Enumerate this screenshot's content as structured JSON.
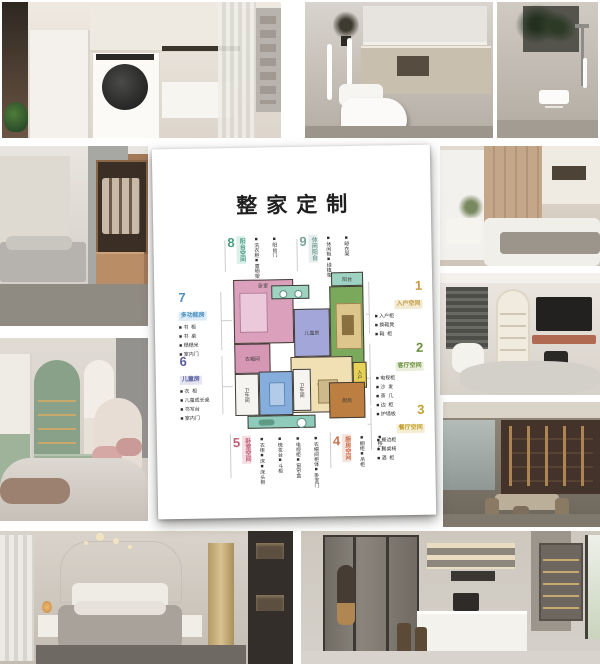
{
  "poster": {
    "title": "整家定制",
    "zones": {
      "z1": {
        "num": "1",
        "name": "入户空间",
        "color": "#c49a3f",
        "tint": "#f3ead3",
        "items": [
          "入户柜",
          "换鞋凳",
          "鞋  柜"
        ]
      },
      "z2": {
        "num": "2",
        "name": "客厅空间",
        "color": "#6b8f3f",
        "tint": "#e9efdb",
        "items": [
          "电视柜",
          "沙  发",
          "茶  几",
          "边  柜",
          "护墙板"
        ]
      },
      "z3": {
        "num": "3",
        "name": "餐厅空间",
        "color": "#c2a02e",
        "tint": "#f4edd2",
        "items": [
          "餐边柜",
          "餐桌椅",
          "酒  柜"
        ]
      },
      "z4": {
        "num": "4",
        "name": "厨房空间",
        "color": "#cd6f4e",
        "tint": "#f6e4dc",
        "items": [
          "橱柜",
          "吊柜",
          "移门"
        ]
      },
      "z5": {
        "num": "5",
        "name": "卧室空间",
        "color": "#c05c74",
        "tint": "#f5dee4",
        "items": [
          "衣柜",
          "床",
          "床头柜",
          "梳妆台",
          "斗柜",
          "电视柜",
          "窗帘盒",
          "衣帽间柜体",
          "卧室门"
        ]
      },
      "z6": {
        "num": "6",
        "name": "儿童房",
        "color": "#5c5fa0",
        "tint": "#e3e4f0",
        "items": [
          "衣  柜",
          "儿童成长桌",
          "书写台",
          "室内门"
        ]
      },
      "z7": {
        "num": "7",
        "name": "多功能房",
        "color": "#4a8fc2",
        "tint": "#dcebf5",
        "items": [
          "书  柜",
          "书  桌",
          "榻榻米",
          "室内门"
        ]
      },
      "z8": {
        "num": "8",
        "name": "阳台空间",
        "color": "#4d9e86",
        "tint": "#def0ea",
        "items": [
          "洗衣柜",
          "置物架",
          "阳台门"
        ]
      },
      "z9": {
        "num": "9",
        "name": "休闲阳台",
        "color": "#79a39b",
        "tint": "#e6efed",
        "items": [
          "休闲柜",
          "绿植架",
          "晾衣架"
        ]
      }
    },
    "rooms": {
      "bedroom": {
        "label": "卧室",
        "color": "#dba0bc"
      },
      "closet": {
        "label": "衣帽间",
        "color": "#d697b4"
      },
      "kids": {
        "label": "儿童房",
        "color": "#a2a6d8"
      },
      "living": {
        "label": "客厅",
        "color": "#7aa95c"
      },
      "balcony_top": {
        "label": "阳台",
        "color": "#9ed3c2"
      },
      "laundry_strip": {
        "label": "",
        "color": "#9ed3c2"
      },
      "dining": {
        "label": "餐厅",
        "color": "#f1e0b4"
      },
      "entry": {
        "label": "入户",
        "color": "#e8d255"
      },
      "study": {
        "label": "书房",
        "color": "#85aedd"
      },
      "bath1": {
        "label": "卫生间",
        "color": "#f5f4f1"
      },
      "bath2": {
        "label": "卫生间",
        "color": "#f5f4f1"
      },
      "balcony_bottom": {
        "label": "阳台",
        "color": "#8fcbbb"
      },
      "kitchen": {
        "label": "厨房",
        "color": "#bc7f41"
      }
    }
  }
}
